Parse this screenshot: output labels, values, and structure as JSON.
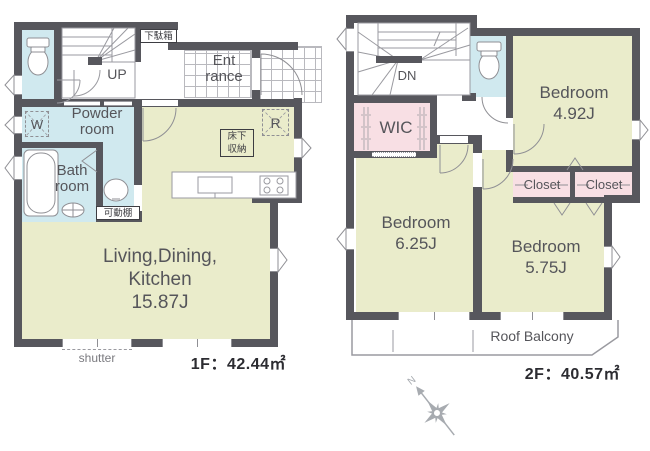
{
  "floor1": {
    "area_label": "1F：42.44㎡",
    "rooms": {
      "ldk": {
        "name_line1": "Living,Dining,",
        "name_line2": "Kitchen",
        "size": "15.87J"
      },
      "powder": {
        "line1": "Powder",
        "line2": "room"
      },
      "bath": {
        "line1": "Bath",
        "line2": "room"
      },
      "entrance": {
        "line1": "Ent",
        "line2": "rance"
      }
    },
    "labels": {
      "up": "UP",
      "shoe_cabinet": "下駄箱",
      "washer": "W",
      "fridge": "R",
      "underfloor_line1": "床下",
      "underfloor_line2": "収納",
      "movable_shelf": "可動棚",
      "shutter": "shutter"
    }
  },
  "floor2": {
    "area_label": "2F：40.57㎡",
    "rooms": {
      "bedroom_a": {
        "name": "Bedroom",
        "size": "4.92J"
      },
      "bedroom_b": {
        "name": "Bedroom",
        "size": "6.25J"
      },
      "bedroom_c": {
        "name": "Bedroom",
        "size": "5.75J"
      },
      "wic": "WIC",
      "closet_a": "Closet",
      "closet_b": "Closet",
      "balcony": "Roof Balcony"
    },
    "labels": {
      "down": "DN"
    }
  },
  "compass": {
    "north": "N"
  },
  "colors": {
    "wall": "#57575d",
    "room_green": "#eaeccb",
    "room_blue": "#d0e9ef",
    "room_pink": "#f8dfe4"
  }
}
